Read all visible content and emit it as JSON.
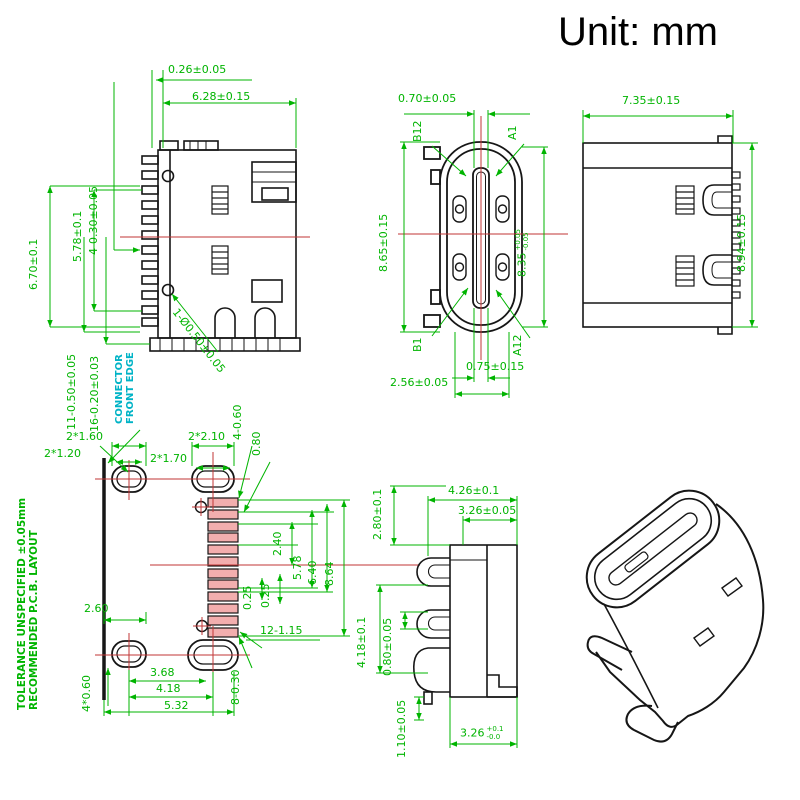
{
  "unit_label": "Unit: mm",
  "colors": {
    "dimension_green": "#00b400",
    "annotation_cyan": "#00b3c6",
    "centerline_red": "#c23535",
    "drawing_black": "#161616",
    "pad_pink": "#f2aeae"
  },
  "front_view": {
    "d_026": "0.26±0.05",
    "d_628": "6.28±0.15",
    "d_4_030": "4-0.30±0.05",
    "d_578": "5.78±0.1",
    "d_670": "6.70±0.1",
    "d_11_050": "11-0.50±0.05",
    "d_16_020": "16-0.20±0.03",
    "d_hole": "1-Ø0.50±0.05",
    "edge_note_line1": "CONNECTOR",
    "edge_note_line2": "FRONT EDGE"
  },
  "top_view": {
    "d_070": "0.70±0.05",
    "pin_b12": "B12",
    "pin_a1": "A1",
    "pin_b1": "B1",
    "pin_a12": "A12",
    "d_865": "8.65±0.15",
    "d_835_base": "8.35",
    "d_835_tol_plus": "+0.05",
    "d_835_tol_minus": "-0.05",
    "d_075": "0.75±0.15",
    "d_256": "2.56±0.05"
  },
  "side_view": {
    "d_735": "7.35±0.15",
    "d_894": "8.94±0.15"
  },
  "pcb_layout": {
    "note_line1": "TOLERANCE UNSPECIFIED ±0.05mm",
    "note_line2": "RECOMMENDED  P.C.B.  LAYOUT",
    "d_2x160": "2*1.60",
    "d_2x120": "2*1.20",
    "d_2x210": "2*2.10",
    "d_2x170": "2*1.70",
    "d_4_060": "4-0.60",
    "d_080": "0.80",
    "d_240": "2.40",
    "d_578": "5.78",
    "d_640": "6.40",
    "d_864": "8.64",
    "d_025_left": "0.25",
    "d_025_right": "0.25",
    "d_12_115": "12-1.15",
    "d_8_030": "8-0.30",
    "d_260": "2.60",
    "d_4x060": "4*0.60",
    "d_368": "3.68",
    "d_418": "4.18",
    "d_532": "5.32"
  },
  "profile_view": {
    "d_426": "4.26±0.1",
    "d_326_top": "3.26±0.05",
    "d_280": "2.80±0.1",
    "d_418": "4.18±0.1",
    "d_080": "0.80±0.05",
    "d_110": "1.10±0.05",
    "d_326_base": "3.26",
    "d_326_tol_plus": "+0.1",
    "d_326_tol_minus": "-0.0"
  }
}
